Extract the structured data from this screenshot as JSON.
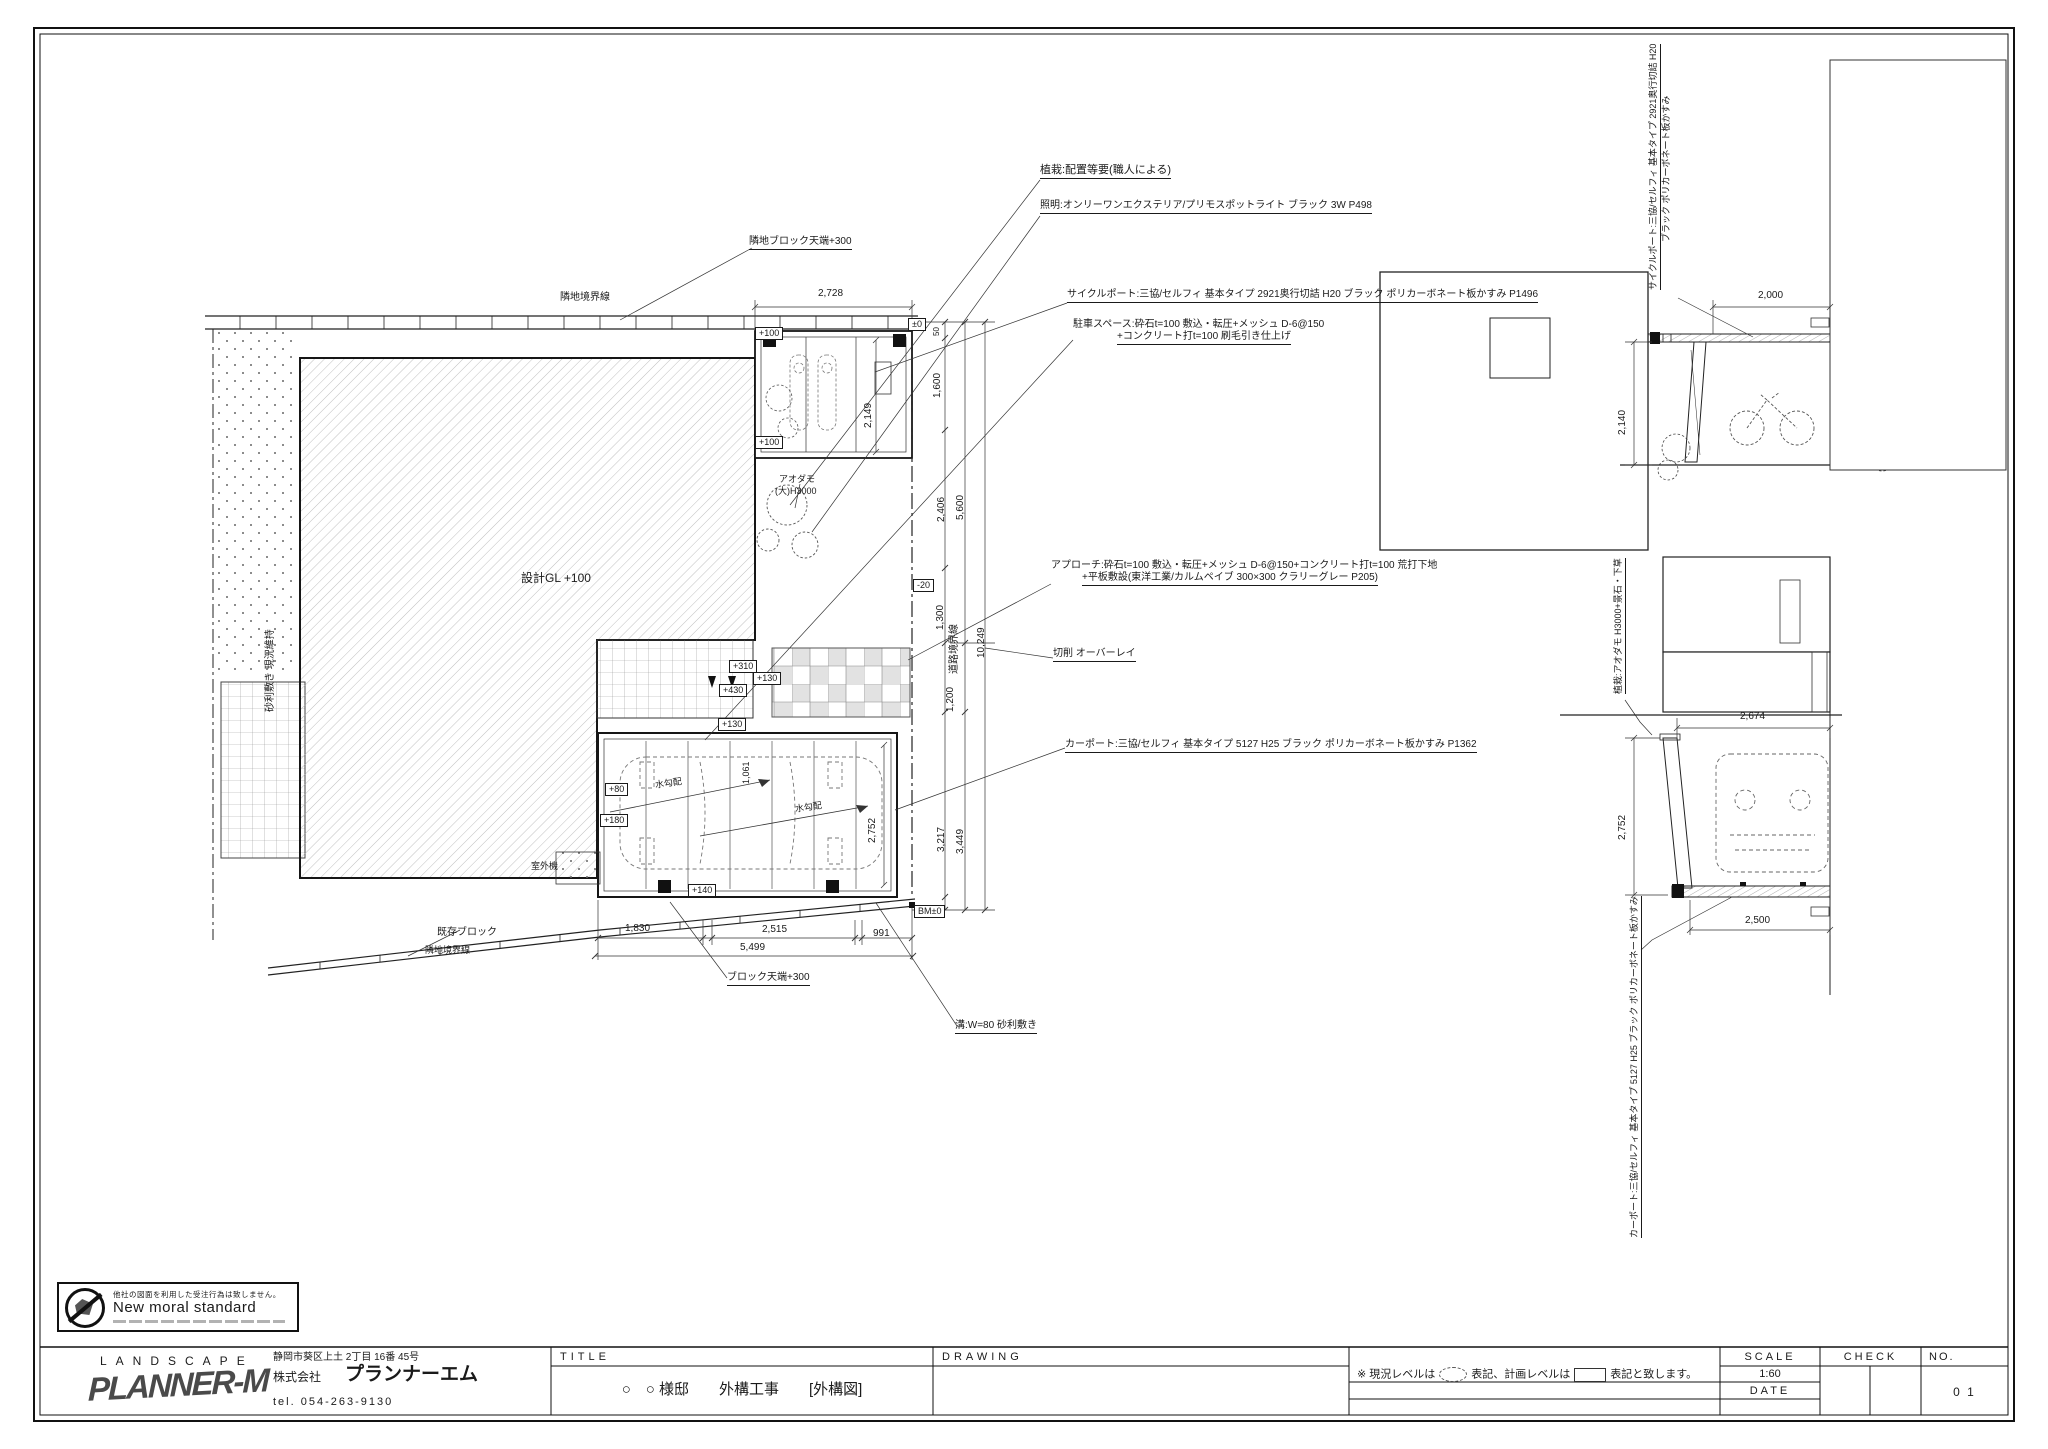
{
  "stamp": {
    "line1": "他社の図面を利用した受注行為は致しません。",
    "line2": "New moral standard"
  },
  "title_block": {
    "brand_top": "LANDSCAPE",
    "brand_logo": "PLANNER-M",
    "address": "静岡市葵区上土 2丁目 16番 45号",
    "company_prefix": "株式会社",
    "company_name": "プランナーエム",
    "tel": "tel. 054-263-9130",
    "label_title": "TITLE",
    "title_value": "○　○ 様邸　　外構工事　　[外構図]",
    "label_drawing": "DRAWING",
    "note_p1": "※ 現況レベルは",
    "note_p2": "表記、計画レベルは",
    "note_p3": "表記と致します。",
    "label_scale": "SCALE",
    "scale_value": "1:60",
    "label_date": "DATE",
    "label_check": "CHECK",
    "label_no": "NO.",
    "no_value": "0 1"
  },
  "annotations": [
    {
      "n": "plant-note",
      "t": "植栽:配置等要(職人による)",
      "x": 1040,
      "y": 165,
      "s": 11,
      "u": true
    },
    {
      "n": "light-note",
      "t": "照明:オンリーワンエクステリア/プリモスポットライト ブラック 3W P498",
      "x": 1040,
      "y": 201,
      "s": 10,
      "u": true
    },
    {
      "n": "cycleport-note",
      "t": "サイクルポート:三協/セルフィ 基本タイプ 2921奥行切詰 H20 ブラック ポリカーボネート板かすみ P1496",
      "x": 1067,
      "y": 290,
      "s": 10,
      "u": true
    },
    {
      "n": "parking-note-1",
      "t": "駐車スペース:砕石t=100 敷込・転圧+メッシュ D-6@150",
      "x": 1073,
      "y": 320,
      "s": 10
    },
    {
      "n": "parking-note-2",
      "t": "+コンクリート打t=100 刷毛引き仕上げ",
      "x": 1117,
      "y": 332,
      "s": 10,
      "u": true
    },
    {
      "n": "approach-note-1",
      "t": "アプローチ:砕石t=100 敷込・転圧+メッシュ D-6@150+コンクリート打t=100 荒打下地",
      "x": 1051,
      "y": 561,
      "s": 10
    },
    {
      "n": "approach-note-2",
      "t": "+平板敷設(東洋工業/カルムペイブ 300×300 クラリーグレー P205)",
      "x": 1082,
      "y": 573,
      "s": 10,
      "u": true
    },
    {
      "n": "overlay-note",
      "t": "切削 オーバーレイ",
      "x": 1053,
      "y": 649,
      "s": 10,
      "u": true
    },
    {
      "n": "carport-note",
      "t": "カーポート:三協/セルフィ 基本タイプ 5127 H25 ブラック ポリカーボネート板かすみ P1362",
      "x": 1065,
      "y": 740,
      "s": 10,
      "u": true
    },
    {
      "n": "neighbor-block-note",
      "t": "隣地ブロック天端+300",
      "x": 749,
      "y": 237,
      "s": 10,
      "u": true
    },
    {
      "n": "boundary-label-top",
      "t": "隣地境界線",
      "x": 560,
      "y": 293,
      "s": 10
    },
    {
      "n": "design-gl-label",
      "t": "設計GL +100",
      "x": 521,
      "y": 572,
      "s": 12
    },
    {
      "n": "tree-label-1",
      "t": "アオダモ",
      "x": 779,
      "y": 475,
      "s": 9
    },
    {
      "n": "tree-label-2",
      "t": "(大)H3000",
      "x": 775,
      "y": 487,
      "s": 9
    },
    {
      "n": "outdoor-unit-label",
      "t": "室外機",
      "x": 531,
      "y": 862,
      "s": 9
    },
    {
      "n": "existing-block-label",
      "t": "既存ブロック",
      "x": 437,
      "y": 928,
      "s": 10
    },
    {
      "n": "boundary-label-bottom",
      "t": "隣地境界線",
      "x": 425,
      "y": 946,
      "s": 9
    },
    {
      "n": "block-top-note",
      "t": "ブロック天端+300",
      "x": 727,
      "y": 973,
      "s": 10,
      "u": true
    },
    {
      "n": "gutter-note",
      "t": "溝:W=80 砂利敷き",
      "x": 955,
      "y": 1021,
      "s": 10,
      "u": true
    },
    {
      "n": "slope-label-1",
      "t": "水勾配",
      "x": 655,
      "y": 779,
      "s": 9,
      "r": -8
    },
    {
      "n": "slope-label-2",
      "t": "水勾配",
      "x": 795,
      "y": 803,
      "s": 9,
      "r": -8
    },
    {
      "n": "gravel-label",
      "t": "砂利敷き 現況維持",
      "x": 266,
      "y": 712,
      "s": 10,
      "v": true
    },
    {
      "n": "road-boundary-label",
      "t": "道路境界線",
      "x": 950,
      "y": 674,
      "s": 10,
      "v": true
    },
    {
      "n": "elev-cycleport-label-1",
      "t": "サイクルポート:三協/セルフィ 基本タイプ 2921奥行切詰 H20",
      "x": 1649,
      "y": 290,
      "s": 9,
      "v": true,
      "u": true
    },
    {
      "n": "elev-cycleport-label-2",
      "t": "ブラック ポリカーボネート板かすみ",
      "x": 1662,
      "y": 242,
      "s": 9,
      "v": true
    },
    {
      "n": "elev-planting-label",
      "t": "植栽:アオダモ H3000+景石・下草",
      "x": 1614,
      "y": 694,
      "s": 9,
      "v": true,
      "u": true
    },
    {
      "n": "elev-carport-label",
      "t": "カーポート:三協/セルフィ 基本タイプ 5127 H25 ブラック ポリカーボネート板かすみ",
      "x": 1630,
      "y": 1238,
      "s": 9,
      "v": true,
      "u": true
    },
    {
      "n": "dim-2728",
      "t": "2,728",
      "x": 818,
      "y": 289,
      "s": 10
    },
    {
      "n": "dim-2000",
      "t": "2,000",
      "x": 1758,
      "y": 291,
      "s": 10
    },
    {
      "n": "dim-2674",
      "t": "2,674",
      "x": 1740,
      "y": 712,
      "s": 10
    },
    {
      "n": "dim-2500",
      "t": "2,500",
      "x": 1745,
      "y": 916,
      "s": 10
    },
    {
      "n": "dim-1830",
      "t": "1,830",
      "x": 625,
      "y": 924,
      "s": 10
    },
    {
      "n": "dim-2515",
      "t": "2,515",
      "x": 762,
      "y": 925,
      "s": 10
    },
    {
      "n": "dim-991",
      "t": "991",
      "x": 873,
      "y": 929,
      "s": 10
    },
    {
      "n": "dim-5499",
      "t": "5,499",
      "x": 740,
      "y": 943,
      "s": 10
    },
    {
      "n": "dim-2149",
      "t": "2,149",
      "x": 864,
      "y": 428,
      "s": 10,
      "v": true
    },
    {
      "n": "dim-1600",
      "t": "1,600",
      "x": 933,
      "y": 398,
      "s": 10,
      "v": true
    },
    {
      "n": "dim-2406",
      "t": "2,406",
      "x": 937,
      "y": 522,
      "s": 10,
      "v": true
    },
    {
      "n": "dim-5600",
      "t": "5,600",
      "x": 956,
      "y": 520,
      "s": 10,
      "v": true
    },
    {
      "n": "dim-1300",
      "t": "1,300",
      "x": 936,
      "y": 630,
      "s": 10,
      "v": true
    },
    {
      "n": "dim-10249",
      "t": "10,249",
      "x": 977,
      "y": 658,
      "s": 10,
      "v": true
    },
    {
      "n": "dim-1200",
      "t": "1,200",
      "x": 946,
      "y": 712,
      "s": 10,
      "v": true
    },
    {
      "n": "dim-3217",
      "t": "3,217",
      "x": 937,
      "y": 852,
      "s": 10,
      "v": true
    },
    {
      "n": "dim-3449",
      "t": "3,449",
      "x": 956,
      "y": 854,
      "s": 10,
      "v": true
    },
    {
      "n": "dim-50-top",
      "t": "50",
      "x": 933,
      "y": 336,
      "s": 8,
      "v": true
    },
    {
      "n": "dim-50-bottom",
      "t": "50",
      "x": 929,
      "y": 914,
      "s": 8,
      "v": true
    },
    {
      "n": "dim-2140",
      "t": "2,140",
      "x": 1618,
      "y": 435,
      "s": 10,
      "v": true
    },
    {
      "n": "dim-2752-elev",
      "t": "2,752",
      "x": 1618,
      "y": 840,
      "s": 10,
      "v": true
    },
    {
      "n": "dim-2752-plan",
      "t": "2,752",
      "x": 868,
      "y": 843,
      "s": 10,
      "v": true
    },
    {
      "n": "dim-1061",
      "t": "1,061",
      "x": 742,
      "y": 784,
      "s": 9,
      "v": true
    },
    {
      "n": "level-pm0",
      "t": "±0",
      "x": 908,
      "y": 318,
      "s": 9,
      "b": true
    },
    {
      "n": "level-m20",
      "t": "-20",
      "x": 913,
      "y": 579,
      "s": 9,
      "b": true
    },
    {
      "n": "level-bm0",
      "t": "BM±0",
      "x": 914,
      "y": 905,
      "s": 9,
      "b": true
    },
    {
      "n": "level-p100a",
      "t": "+100",
      "x": 755,
      "y": 327,
      "s": 9,
      "b": true
    },
    {
      "n": "level-p100b",
      "t": "+100",
      "x": 755,
      "y": 436,
      "s": 9,
      "b": true
    },
    {
      "n": "level-p130a",
      "t": "+130",
      "x": 753,
      "y": 672,
      "s": 9,
      "b": true
    },
    {
      "n": "level-p130b",
      "t": "+130",
      "x": 718,
      "y": 718,
      "s": 9,
      "b": true
    },
    {
      "n": "level-p310",
      "t": "+310",
      "x": 729,
      "y": 660,
      "s": 9,
      "b": true
    },
    {
      "n": "level-p430",
      "t": "+430",
      "x": 719,
      "y": 684,
      "s": 9,
      "b": true
    },
    {
      "n": "level-p80",
      "t": "+80",
      "x": 605,
      "y": 783,
      "s": 9,
      "b": true
    },
    {
      "n": "level-p180",
      "t": "+180",
      "x": 600,
      "y": 814,
      "s": 9,
      "b": true
    },
    {
      "n": "level-p140",
      "t": "+140",
      "x": 688,
      "y": 884,
      "s": 9,
      "b": true
    }
  ]
}
